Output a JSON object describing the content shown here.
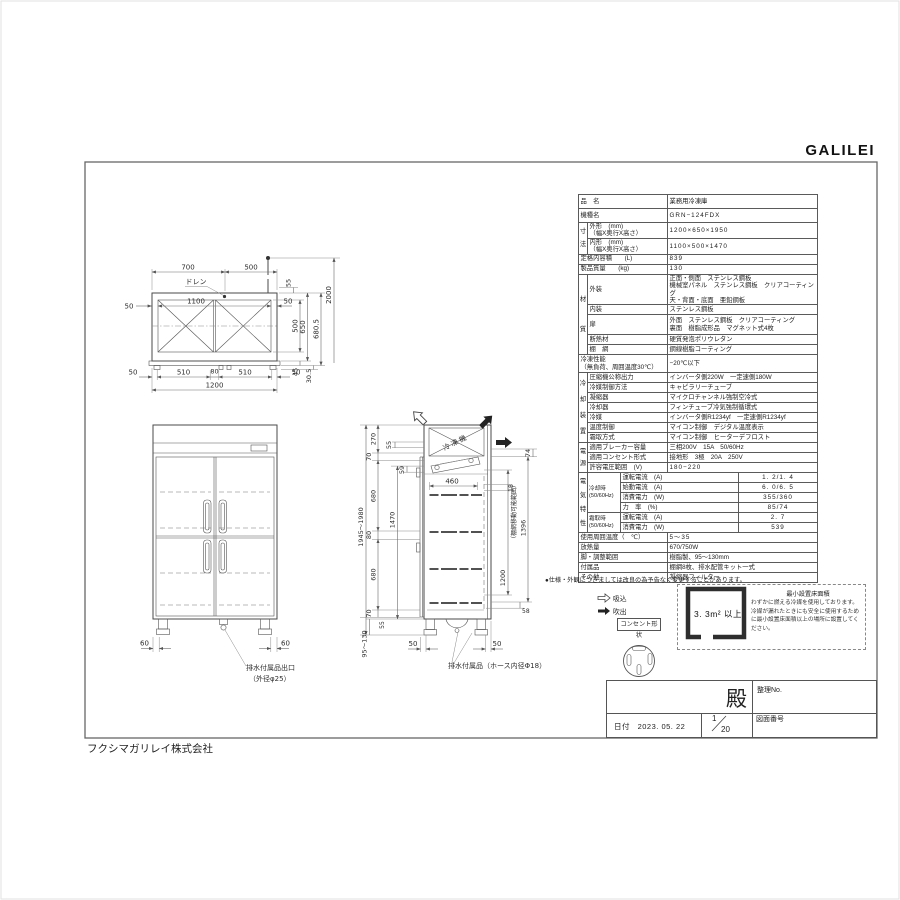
{
  "page": {
    "logo": "GALILEI",
    "company": "フクシマガリレイ株式会社",
    "note": "●仕様・外観につきましては改良の為予告なく変更することがあります。"
  },
  "spec": {
    "v_sun": "寸\n法",
    "v_zai": "材\n質",
    "v_rei": "冷\n却\n装\n置",
    "v_den": "電\n源",
    "v_dtk": "電\n気\n特\n性",
    "hinmei_l": "品　名",
    "hinmei_v": "業務用冷凍庫",
    "kishu_l": "機種名",
    "kishu_v": "GRN−124FDX",
    "gaikei_l": "外形　(mm)\n（幅X奥行X高さ）",
    "gaikei_v": "1200×650×1950",
    "naikei_l": "内形　(mm)\n（幅X奥行X高さ）",
    "naikei_v": "1100×500×1470",
    "naiyo_l": "定格内容積　　(L)",
    "naiyo_v": "839",
    "mass_l": "製品質量　　(kg)",
    "mass_v": "130",
    "gaiso_l": "外装",
    "gaiso_v": "正面・側面　ステンレス鋼板\n機械室パネル　ステンレス鋼板　クリアコーティング\n天・背面・底面　亜鉛鋼板",
    "naiso_l": "内装",
    "naiso_v": "ステンレス鋼板",
    "tobira_l": "扉",
    "tobira_v": "外面　ステンレス鋼板　クリアコーティング\n裏面　樹脂成形品　マグネット式4枚",
    "dan_l": "断熱材",
    "dan_v": "硬質発泡ポリウレタン",
    "tana_l": "棚　網",
    "tana_v": "鋼線樹脂コーティング",
    "seino_l": "冷凍性能\n（無負荷、周囲温度30℃）",
    "seino_v": "−20℃以下",
    "comp_l": "圧縮機公称出力",
    "comp_v": "インバータ側220W　一定速側180W",
    "rseigyo_l": "冷媒制御方法",
    "rseigyo_v": "キャピラリーチューブ",
    "gyo_l": "凝縮器",
    "gyo_v": "マイクロチャンネル強制空冷式",
    "rkki_l": "冷却器",
    "rkki_v": "フィンチューブ冷気強制循環式",
    "reibai_l": "冷媒",
    "reibai_v": "インバータ側R1234yf　一定速側R1234yf",
    "ondo_l": "温度制御",
    "ondo_v": "マイコン制御　デジタル温度表示",
    "shimo_l": "霜取方式",
    "shimo_v": "マイコン制御　ヒーターデフロスト",
    "brk_l": "適用ブレーカー容量",
    "brk_v": "三相200V　15A　50/60Hz",
    "con_l": "適用コンセント形式",
    "con_v": "接地形　3極　20A　250V",
    "volt_l": "許容電圧範囲　(V)",
    "volt_v": "180−220",
    "cool_h": "冷却時\n(50/60Hz)",
    "frost_h": "霜取時\n(50/60Hz)",
    "unten_l": "運転電流　(A)",
    "unten_v": "1. 2/1. 4",
    "shido_l": "始動電流　(A)",
    "shido_v": "6. 0/6. 5",
    "shohi_l": "消費電力　(W)",
    "shohi_v": "355/360",
    "riki_l": "力　率　(%)",
    "riki_v": "85/74",
    "unten2_l": "運転電流　(A)",
    "unten2_v": "2. 7",
    "shohi2_l": "消費電力　(W)",
    "shohi2_v": "539",
    "shuui_l": "使用周囲温度（　℃）",
    "shuui_v": "5〜35",
    "honetsu_l": "放熱量",
    "honetsu_v": "670/750W",
    "ashi_l": "脚・調整範囲",
    "ashi_v": "樹脂製、95〜130mm",
    "fuzoku_l": "付属品",
    "fuzoku_v": "棚網8枚、排水配管キット一式",
    "sonota_l": "その他",
    "sonota_v": "凝縮器フィルター"
  },
  "plan": {
    "w1": "700",
    "w2": "500",
    "drain": "ドレン",
    "c50l": "50",
    "inw": "1100",
    "c50r": "50",
    "d55": "55",
    "d500": "500",
    "d650": "650",
    "d680": "680.5",
    "d2000": "2000",
    "d45": "45",
    "d305": "30.5",
    "b1": "50",
    "b2": "510",
    "b3": "80",
    "b4": "510",
    "b5": "50",
    "total": "1200"
  },
  "front": {
    "d60l": "60",
    "d60r": "60",
    "lead1": "排水付属品出口",
    "lead2": "（外径φ25）"
  },
  "side": {
    "machine": "冷凍機",
    "d270": "270",
    "d70a": "70",
    "d55a": "55",
    "d59": "59",
    "d680a": "680",
    "d80": "80",
    "d680b": "680",
    "d70b": "70",
    "d55b": "55",
    "d1470": "1470",
    "h": "1945〜1980",
    "leg": "95〜130",
    "d460": "460",
    "d18": "18",
    "d74": "74",
    "d1396": "1396",
    "range": "（棚網移動可能範囲）",
    "d1200": "1200",
    "d58": "58",
    "c50a": "50",
    "c50b": "50",
    "lead": "排水付属品（ホース内径Φ18）"
  },
  "legend": {
    "suction": "吸込",
    "blow": "吹出",
    "outlet": "コンセント形状"
  },
  "minarea": {
    "title": "最小設置床面積",
    "value": "3. 3m² 以上",
    "body": "わずかに燃える冷媒を使用しております。冷媒が漏れたときにも安全に使用するために最小設置床面積以上の場所に設置してください。"
  },
  "tb": {
    "dono": "殿",
    "no": "整理No.",
    "date_label": "日付",
    "date": "2023. 05. 22",
    "num": "1",
    "den": "20",
    "dwg": "図面番号"
  }
}
